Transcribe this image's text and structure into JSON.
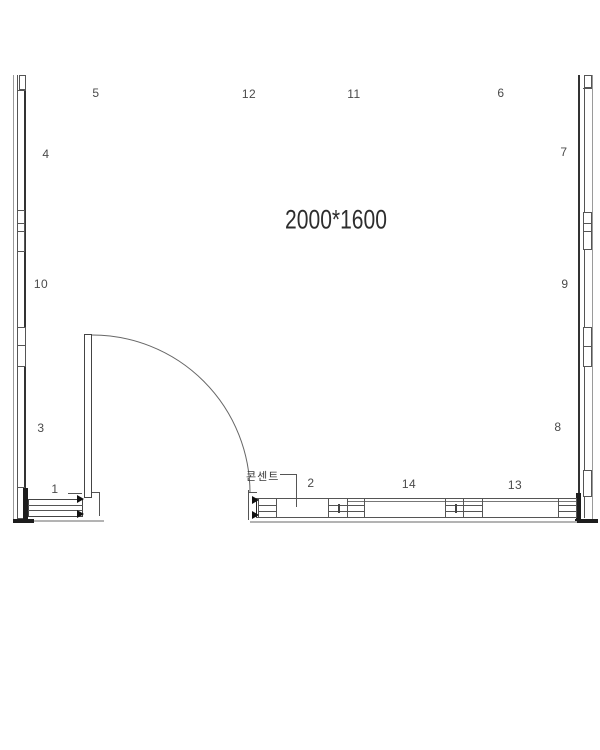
{
  "drawing": {
    "room_size_label": "2000*1600",
    "outlet_label": "콘센트"
  },
  "part_labels": {
    "n1": "1",
    "n2": "2",
    "n3": "3",
    "n4": "4",
    "n5": "5",
    "n6": "6",
    "n7": "7",
    "n8": "8",
    "n9": "9",
    "n10": "10",
    "n11": "11",
    "n12": "12",
    "n13": "13",
    "n14": "14"
  },
  "colors": {
    "ink": "#555555",
    "heavy_ink": "#1d1d1d",
    "label_ink": "#4a4a4a",
    "shadow": "#b3b3b3",
    "background": "#ffffff"
  }
}
